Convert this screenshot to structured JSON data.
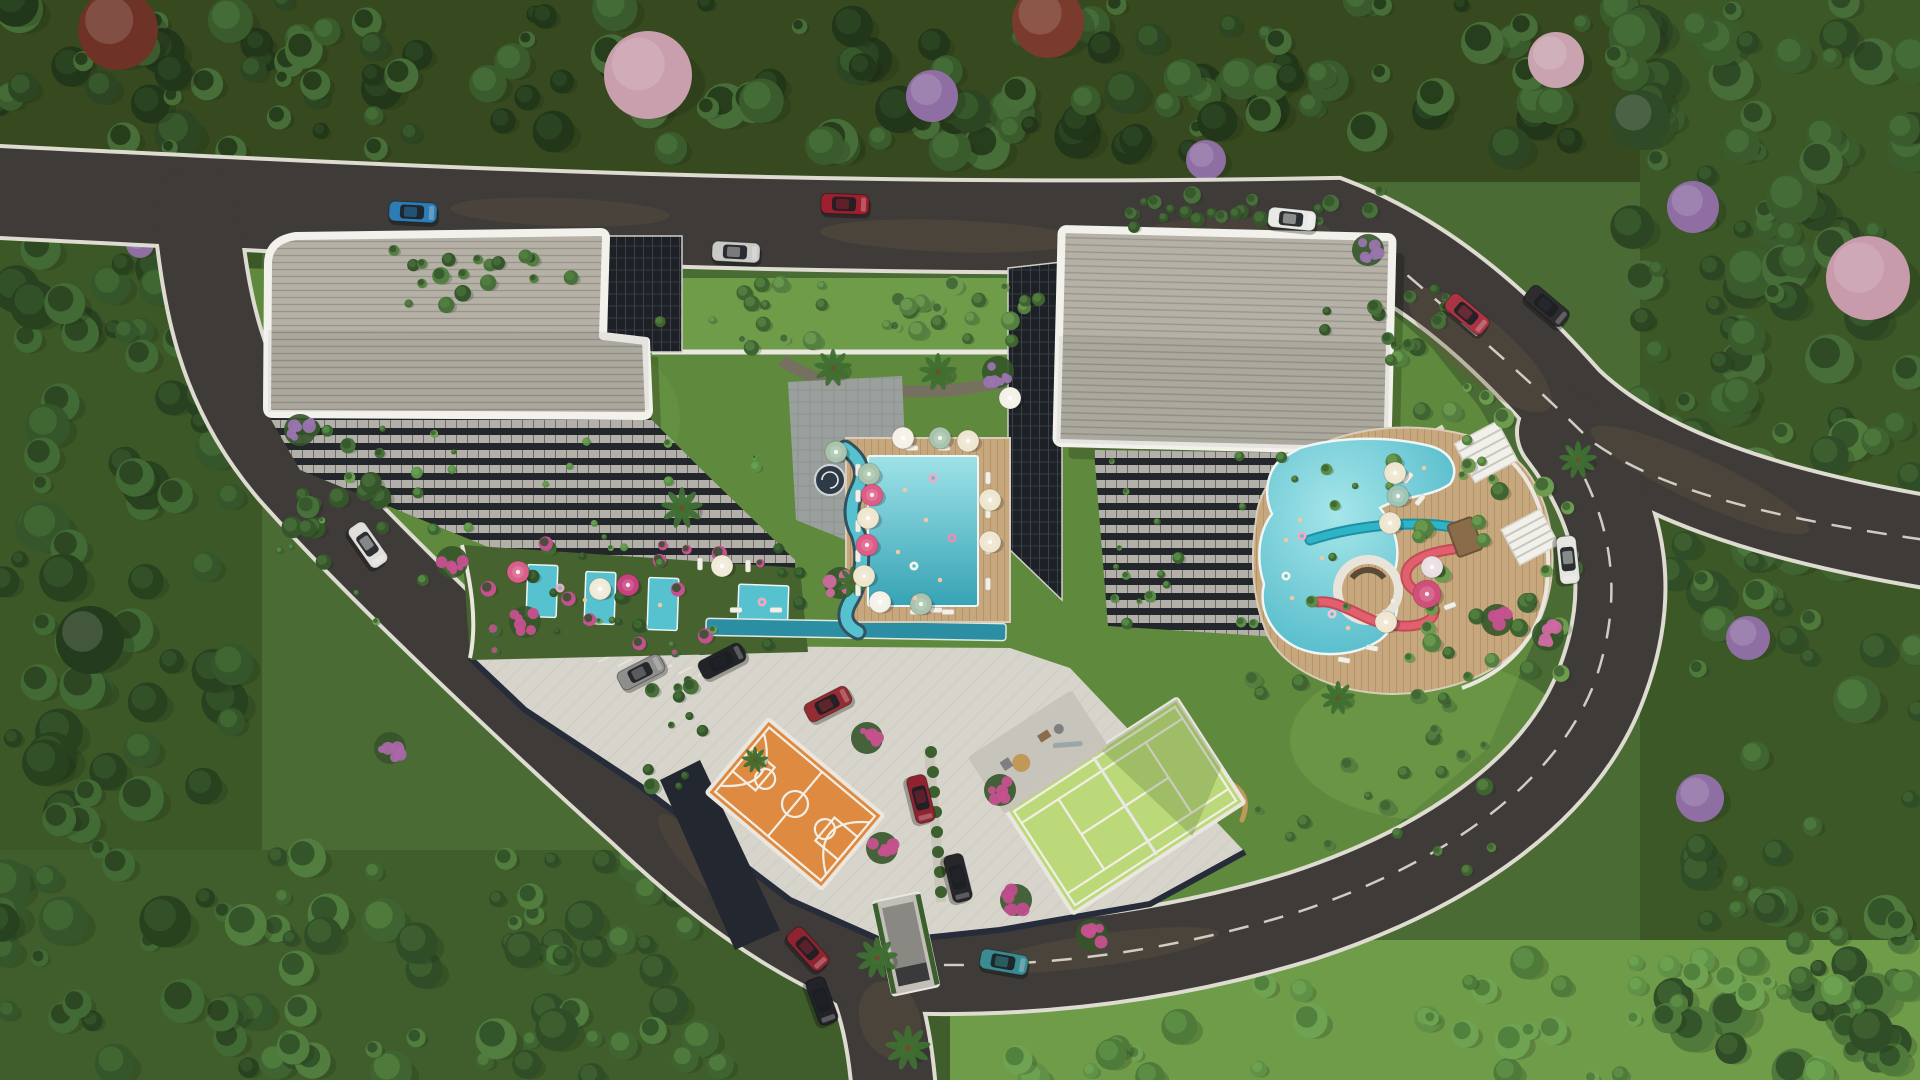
{
  "scene": {
    "type": "architectural-aerial-render",
    "description": "Aerial view of a residential complex: two gray-roofed apartment towers with stepped balconies, central swimming pool with umbrellas, lazy river, aqua-park lagoon pool with teal and pink water slides and swim-up bar, private garden pools, orange basketball court, green tennis court, playground, parking plaza and ring road surrounded by dense forest."
  },
  "palette": {
    "base_green": "#4a6b33",
    "top_forest": "#36491f",
    "side_forest": "#3c5827",
    "lawn": "#5f8a3e",
    "lawn_light": "#6f9c49",
    "lawn_bright": "#7fae57",
    "road": "#3e3b38",
    "road_edge": "#dedbd1",
    "road_dirt": "#6a5843",
    "plaza": "#d7d4cb",
    "plaza_line": "#c6c3b9",
    "wall_navy": "#262c3a",
    "wall_white": "#e9e7df",
    "roof": "#b5b1a7",
    "roof_line": "#99958b",
    "roof_trim": "#f2f1ec",
    "facade": "#1d2125",
    "glass_line": "#39414a",
    "slab": "#b3b0a9",
    "slab_gap": "#23262b",
    "deck": "#c7a87e",
    "deck_line": "#b0905f",
    "stone": "#9aa09e",
    "stone_line": "#878c89",
    "rock": "#75705f",
    "pool": "#56c2cf",
    "pool_deep": "#36a3b5",
    "pool_light": "#9fe2e8",
    "lap": "#2b8ea3",
    "court_orange": "#df8a41",
    "court_green": "#bcd97a",
    "line_white": "#f2efe6",
    "slide_teal": "#2fb3c7",
    "slide_pink": "#e2606e",
    "pergola": "#f2f0ea",
    "hedge": "#3c5f2e",
    "palm_green": "#3f6f31",
    "trunk": "#6d4f30",
    "garden_dark": "#46622f",
    "water_edge": "#eef6f6",
    "flower_magenta": "#c6518f",
    "flower_purple": "#8f6fa3"
  },
  "buildings": [
    {
      "name": "west-tower",
      "roof": "gray-tiled-L-shape",
      "trim": "white"
    },
    {
      "name": "east-tower",
      "roof": "gray-tiled-rect",
      "trim": "white"
    }
  ],
  "amenities": [
    "main-swimming-pool",
    "lazy-river",
    "lap-pool",
    "aqua-park-lagoon",
    "water-slide-teal",
    "water-slide-pink",
    "swim-up-bar",
    "private-garden-pools",
    "basketball-court",
    "tennis-court",
    "playground",
    "pergolas",
    "parking-plaza",
    "garage-ramp"
  ],
  "cars": [
    {
      "c": "#2e7cb5",
      "x": 413,
      "y": 212,
      "r": 3,
      "k": "blue-hatchback"
    },
    {
      "c": "#c9c9c6",
      "x": 736,
      "y": 252,
      "r": 3,
      "k": "silver-car"
    },
    {
      "c": "#9e1f2d",
      "x": 845,
      "y": 204,
      "r": 2,
      "k": "red-car"
    },
    {
      "c": "#e9e9e6",
      "x": 1292,
      "y": 219,
      "r": 6,
      "k": "white-suv"
    },
    {
      "c": "#a93544",
      "x": 1467,
      "y": 314,
      "r": 40,
      "k": "red-car"
    },
    {
      "c": "#2d2d30",
      "x": 1547,
      "y": 306,
      "r": 40,
      "k": "black-pickup"
    },
    {
      "c": "#e0dfdb",
      "x": 368,
      "y": 545,
      "r": 55,
      "k": "white-pickup"
    },
    {
      "c": "#232427",
      "x": 722,
      "y": 661,
      "r": -27,
      "k": "black-sedan"
    },
    {
      "c": "#8e8e8c",
      "x": 641,
      "y": 672,
      "r": -27,
      "k": "gray-car"
    },
    {
      "c": "#952c33",
      "x": 828,
      "y": 704,
      "r": -27,
      "k": "red-car"
    },
    {
      "c": "#8f2430",
      "x": 921,
      "y": 799,
      "r": 76,
      "k": "red-sedan"
    },
    {
      "c": "#26262b",
      "x": 958,
      "y": 878,
      "r": 76,
      "k": "black-sedan"
    },
    {
      "c": "#3a8b92",
      "x": 1004,
      "y": 962,
      "r": 10,
      "k": "teal-car"
    },
    {
      "c": "#8f2430",
      "x": 808,
      "y": 949,
      "r": 48,
      "k": "red-car"
    },
    {
      "c": "#222228",
      "x": 822,
      "y": 1001,
      "r": 70,
      "k": "black-car"
    },
    {
      "c": "#e6e5e1",
      "x": 1568,
      "y": 560,
      "r": 84,
      "k": "white-car"
    }
  ],
  "umbrellas": [
    [
      903,
      438,
      "#f4f1e8"
    ],
    [
      940,
      438,
      "#a9c3ac"
    ],
    [
      968,
      441,
      "#efe6cf"
    ],
    [
      869,
      474,
      "#a9c3ac"
    ],
    [
      872,
      495,
      "#df5c86"
    ],
    [
      868,
      518,
      "#efe6cf"
    ],
    [
      867,
      545,
      "#df5c86"
    ],
    [
      864,
      576,
      "#efe6cf"
    ],
    [
      880,
      602,
      "#f4f1e8"
    ],
    [
      921,
      604,
      "#a9c3ac"
    ],
    [
      990,
      500,
      "#efe6cf"
    ],
    [
      990,
      542,
      "#efe6cf"
    ],
    [
      1010,
      398,
      "#f4f1e8"
    ],
    [
      1395,
      473,
      "#efe6cf"
    ],
    [
      1398,
      496,
      "#9fc4b5"
    ],
    [
      1390,
      523,
      "#efe6cf"
    ],
    [
      1386,
      622,
      "#efe6cf"
    ],
    [
      1432,
      567,
      "#eadfe2"
    ],
    [
      1427,
      594,
      "#cf4f7a",
      14
    ],
    [
      518,
      572,
      "#d95f8a"
    ],
    [
      600,
      589,
      "#f0ead8"
    ],
    [
      628,
      585,
      "#c8407e"
    ],
    [
      722,
      566,
      "#f0ead8"
    ],
    [
      836,
      452,
      "#a9c3ac"
    ]
  ],
  "loungers": [
    [
      858,
      470,
      0
    ],
    [
      858,
      496,
      0
    ],
    [
      858,
      526,
      0
    ],
    [
      858,
      556,
      0
    ],
    [
      858,
      590,
      0
    ],
    [
      988,
      478,
      0
    ],
    [
      988,
      512,
      0
    ],
    [
      988,
      548,
      0
    ],
    [
      988,
      584,
      0
    ],
    [
      912,
      448,
      90
    ],
    [
      944,
      448,
      90
    ],
    [
      916,
      612,
      90
    ],
    [
      948,
      612,
      90
    ],
    [
      1408,
      478,
      40
    ],
    [
      1420,
      500,
      40
    ],
    [
      1372,
      648,
      100
    ],
    [
      1344,
      660,
      100
    ],
    [
      1450,
      606,
      70
    ],
    [
      736,
      610,
      90
    ],
    [
      776,
      610,
      90
    ],
    [
      936,
      610,
      90
    ],
    [
      700,
      564,
      0
    ],
    [
      748,
      566,
      0
    ]
  ],
  "swimmers": [
    [
      905,
      490
    ],
    [
      926,
      520
    ],
    [
      898,
      552
    ],
    [
      940,
      580
    ],
    [
      915,
      598
    ],
    [
      1300,
      520
    ],
    [
      1322,
      558
    ],
    [
      1292,
      598
    ],
    [
      1348,
      628
    ],
    [
      1424,
      468
    ],
    [
      1286,
      540
    ],
    [
      585,
      600
    ],
    [
      660,
      605
    ]
  ],
  "floats": [
    [
      933,
      478,
      "#f2a9c4"
    ],
    [
      914,
      566,
      "#f6f3ea"
    ],
    [
      952,
      538,
      "#e88fb0"
    ],
    [
      1302,
      536,
      "#f2a9c4"
    ],
    [
      1332,
      614,
      "#f2c5d5"
    ],
    [
      1286,
      576,
      "#f6f3ea"
    ],
    [
      762,
      602,
      "#f2a9c4"
    ],
    [
      560,
      588,
      "#f2a9c4"
    ]
  ],
  "feature_trees": [
    [
      648,
      75,
      44,
      "#c99fae"
    ],
    [
      118,
      30,
      40,
      "#6e3326"
    ],
    [
      1048,
      22,
      36,
      "#7a3b2c"
    ],
    [
      1868,
      278,
      42,
      "#c79aac"
    ],
    [
      1556,
      60,
      28,
      "#c9a3b0"
    ],
    [
      932,
      96,
      26,
      "#8f6fa3"
    ],
    [
      1206,
      160,
      20,
      "#8f6fa3"
    ],
    [
      1693,
      207,
      26,
      "#8f6fa3"
    ],
    [
      1748,
      638,
      22,
      "#8f6fa3"
    ],
    [
      1700,
      798,
      24,
      "#8f6fa3"
    ],
    [
      420,
      248,
      16,
      "#8f6fa3"
    ],
    [
      140,
      244,
      14,
      "#8f6fa3"
    ],
    [
      1640,
      120,
      30,
      "#2e4a26"
    ],
    [
      90,
      640,
      34,
      "#243c1d"
    ]
  ],
  "flower_clusters": [
    [
      1000,
      790,
      "#c6518f"
    ],
    [
      882,
      848,
      "#c6518f"
    ],
    [
      1016,
      900,
      "#bf4d8c"
    ],
    [
      1092,
      935,
      "#c6518f"
    ],
    [
      525,
      622,
      "#c6518f"
    ],
    [
      390,
      748,
      "#a868a8"
    ],
    [
      1497,
      620,
      "#c6518f"
    ],
    [
      1548,
      635,
      "#cf6aa0"
    ],
    [
      867,
      738,
      "#c6518f"
    ],
    [
      840,
      583,
      "#cf6aa0"
    ],
    [
      998,
      372,
      "#9a74ae"
    ],
    [
      452,
      562,
      "#c6518f"
    ],
    [
      300,
      430,
      "#9a74ae"
    ],
    [
      1368,
      250,
      "#9a74ae"
    ]
  ],
  "palms": [
    [
      833,
      368,
      1
    ],
    [
      938,
      372,
      1
    ],
    [
      852,
      582,
      0.8
    ],
    [
      877,
      958,
      1.1
    ],
    [
      908,
      1048,
      1.2
    ],
    [
      1578,
      460,
      1
    ],
    [
      682,
      508,
      1.1
    ],
    [
      1338,
      698,
      0.9
    ],
    [
      755,
      760,
      0.7
    ]
  ],
  "tree_zones": [
    {
      "x": 0,
      "y": 0,
      "w": 1660,
      "h": 152,
      "n": 150,
      "rmin": 7,
      "rmax": 24,
      "cols": [
        "#2c4522",
        "#3a5c2d",
        "#476e38",
        "#223619"
      ],
      "seed": 7,
      "back": 1
    },
    {
      "x": 1615,
      "y": 0,
      "w": 305,
      "h": 430,
      "n": 70,
      "rmin": 8,
      "rmax": 26,
      "cols": [
        "#2c4522",
        "#3a5c2d",
        "#476e38"
      ],
      "seed": 11,
      "back": 1
    },
    {
      "x": 1665,
      "y": 420,
      "w": 255,
      "h": 660,
      "n": 80,
      "rmin": 8,
      "rmax": 24,
      "cols": [
        "#2f4d26",
        "#3f6331",
        "#4f7a3c"
      ],
      "seed": 13,
      "back": 1
    },
    {
      "x": 0,
      "y": 235,
      "w": 255,
      "h": 845,
      "n": 95,
      "rmin": 8,
      "rmax": 26,
      "cols": [
        "#28411f",
        "#35552a",
        "#426a34"
      ],
      "seed": 17,
      "back": 1
    },
    {
      "x": 245,
      "y": 855,
      "w": 540,
      "h": 225,
      "n": 70,
      "rmin": 7,
      "rmax": 22,
      "cols": [
        "#2f4d26",
        "#3f6331",
        "#517e3e"
      ],
      "seed": 19,
      "back": 1
    },
    {
      "x": 950,
      "y": 960,
      "w": 970,
      "h": 120,
      "n": 48,
      "rmin": 6,
      "rmax": 18,
      "cols": [
        "#4e7a3a",
        "#5f9147",
        "#6fa352"
      ],
      "seed": 23,
      "back": 1
    },
    {
      "x": 656,
      "y": 282,
      "w": 428,
      "h": 66,
      "n": 36,
      "rmin": 4,
      "rmax": 10,
      "cols": [
        "#3f6331",
        "#538040",
        "#6d9b50"
      ],
      "seed": 29
    },
    {
      "x": 1388,
      "y": 352,
      "w": 195,
      "h": 330,
      "n": 40,
      "rmin": 4,
      "rmax": 11,
      "cols": [
        "#3f6331",
        "#538040",
        "#6d9b50"
      ],
      "seed": 31
    },
    {
      "x": 286,
      "y": 428,
      "w": 110,
      "h": 140,
      "n": 16,
      "rmin": 5,
      "rmax": 12,
      "cols": [
        "#35552a",
        "#47703a"
      ],
      "seed": 41
    },
    {
      "x": 470,
      "y": 542,
      "w": 330,
      "h": 112,
      "n": 30,
      "rmin": 3,
      "rmax": 8,
      "cols": [
        "#30512a",
        "#3f6a33",
        "#c6518f"
      ],
      "seed": 43
    },
    {
      "x": 278,
      "y": 420,
      "w": 490,
      "h": 225,
      "n": 34,
      "rmin": 2.5,
      "rmax": 6,
      "cols": [
        "#3f6331",
        "#579046",
        "#6aa152"
      ],
      "seed": 47
    },
    {
      "x": 1095,
      "y": 452,
      "w": 295,
      "h": 180,
      "n": 26,
      "rmin": 2.5,
      "rmax": 6,
      "cols": [
        "#3f6331",
        "#579046"
      ],
      "seed": 53
    },
    {
      "x": 1095,
      "y": 190,
      "w": 295,
      "h": 38,
      "n": 22,
      "rmin": 4,
      "rmax": 9,
      "cols": [
        "#35552a",
        "#47703a"
      ],
      "seed": 59
    },
    {
      "x": 1250,
      "y": 648,
      "w": 250,
      "h": 225,
      "n": 26,
      "rmin": 4,
      "rmax": 9,
      "cols": [
        "#3f6331",
        "#538040"
      ],
      "seed": 61
    },
    {
      "x": 622,
      "y": 680,
      "w": 82,
      "h": 118,
      "n": 12,
      "rmin": 3,
      "rmax": 8,
      "cols": [
        "#35552a",
        "#47703a"
      ],
      "seed": 67
    },
    {
      "x": 380,
      "y": 250,
      "w": 200,
      "h": 60,
      "n": 18,
      "rmin": 4,
      "rmax": 9,
      "cols": [
        "#35552a",
        "#47703a",
        "#538040"
      ],
      "seed": 71
    },
    {
      "x": 1320,
      "y": 285,
      "w": 130,
      "h": 70,
      "n": 14,
      "rmin": 4,
      "rmax": 9,
      "cols": [
        "#35552a",
        "#47703a"
      ],
      "seed": 73
    }
  ]
}
